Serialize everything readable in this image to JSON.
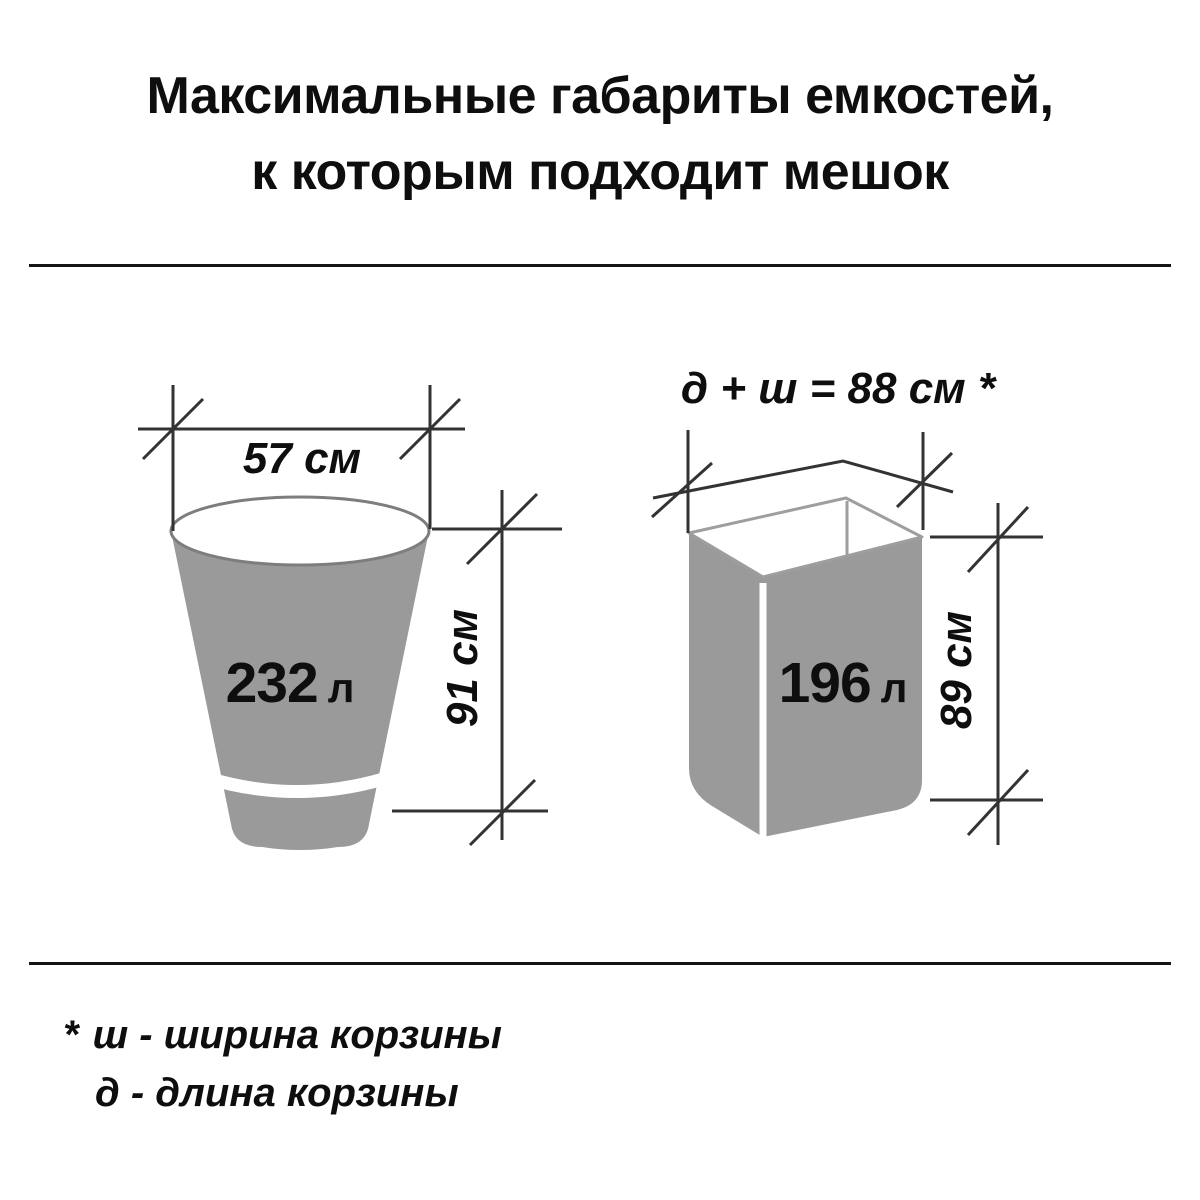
{
  "title": {
    "line1": "Максимальные габариты емкостей,",
    "line2": "к которым подходит мешок"
  },
  "bucket": {
    "width_label": "57 см",
    "height_label": "91 см",
    "volume_value": "232",
    "volume_unit": "л"
  },
  "basket": {
    "formula_label": "д + ш = 88 см *",
    "height_label": "89 см",
    "volume_value": "196",
    "volume_unit": "л"
  },
  "footnote": {
    "marker": "*",
    "line1": "ш - ширина корзины",
    "line2": "д - длина корзины"
  },
  "colors": {
    "container_fill": "#9a9a9a",
    "container_outline": "#7d7d7d",
    "rim_outline": "#9e9e9e",
    "dimension_line": "#333333",
    "divider": "#141414",
    "text": "#0e0e0e"
  }
}
